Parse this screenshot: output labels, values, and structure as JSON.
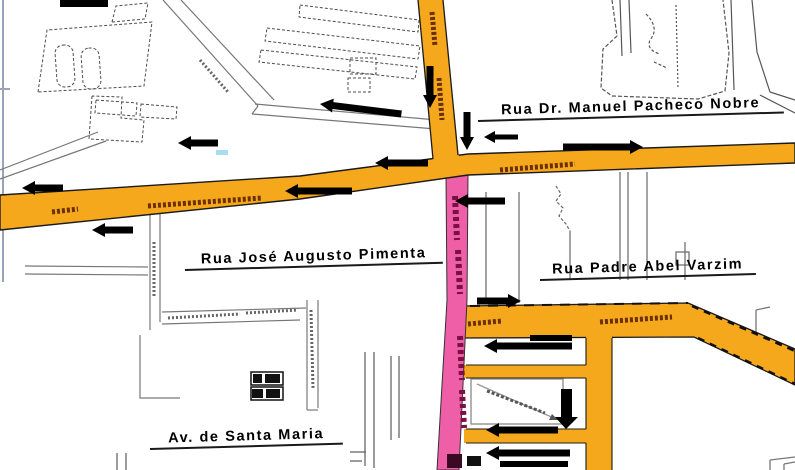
{
  "map": {
    "labels": [
      {
        "text": "Rua Dr. Manuel Pacheco Nobre"
      },
      {
        "text": "Rua José Augusto Pimenta"
      },
      {
        "text": "Rua Padre Abel Varzim"
      },
      {
        "text": "Av. de Santa Maria"
      }
    ],
    "colors": {
      "road_primary": "#F6A81C",
      "road_highlight": "#EE5FA7",
      "road_name_text": "#6B2F00",
      "highlight_name_text": "#7A1044",
      "arrow": "#000000",
      "outline": "#4D4D4D",
      "minor_street": "#777777",
      "frame": "#9AA4B8",
      "water_mark": "#A8DCEE",
      "background": "#FFFFFF"
    }
  }
}
